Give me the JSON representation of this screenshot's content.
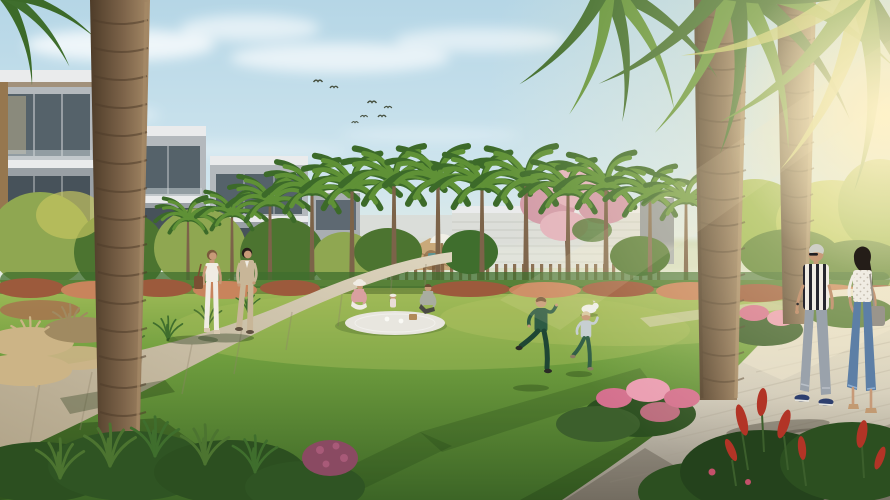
{
  "scene": {
    "description": "Golden-hour architectural rendering of a landscaped community park surrounded by modern villas and date palms",
    "sky": {
      "clouds": true,
      "birds_count": 7,
      "sun_position": "upper-right glare"
    },
    "architecture": [
      "row of modern flat-roof villas with glass balconies on the left",
      "low white slatted community wall and grey buildings behind the central trees"
    ],
    "landscape": [
      "curved beige pedestrian path sweeping from bottom-left to center",
      "wide paved promenade across the bottom-right",
      "large central lawn with long tree shadows",
      "row of date palms along the lawn edge",
      "pink flowering tree at center-right",
      "reddish shrub hedge bordering the lawn",
      "pink and red flowering shrubs beside the promenade",
      "tan ornamental grasses at lower-left",
      "children's playground with wooden lattice huts, white parasol and small teal slide",
      "two large foreground palm trunks with backlit fronds overhead"
    ],
    "people": [
      {
        "id": "path-couple",
        "desc": "woman in white with brown shoulder bag and man in beige suit walking on the curved path"
      },
      {
        "id": "picnic-family",
        "desc": "mother in sun hat, toddler and father seated on a light blanket on the lawn"
      },
      {
        "id": "running-children",
        "desc": "boy in dark green and smaller child in light top running on the grass"
      },
      {
        "id": "promenade-couple",
        "desc": "man in black-and-white striped shirt and woman with long dark hair, white dotted blouse and blue jeans walking on the promenade"
      }
    ],
    "animals": [
      {
        "id": "small-white-dog",
        "desc": "small white dog resting on the lawn near the family"
      }
    ]
  },
  "colors": {
    "sky_top": "#b5d6e6",
    "sky_mid": "#cfe5ee",
    "sky_horizon": "#ecefe0",
    "sun_glow": "#fff2c8",
    "cloud": "#ffffff",
    "lawn_far": "#a3bc59",
    "lawn_mid": "#6f9e3e",
    "lawn_near": "#3c6526",
    "shadow_green": "#16300d",
    "shadow_warm": "#3a352b",
    "path_light": "#ded5bf",
    "path_dark": "#b1a489",
    "walk_light": "#e9e2cd",
    "walk_mid": "#cfc9bb",
    "walk_dark": "#8c8578",
    "trunk_light": "#a68a67",
    "trunk_mid": "#7c6349",
    "trunk_dark": "#4e3c29",
    "palm_dark": "#3c6a29",
    "palm_mid": "#5f9136",
    "palm_light": "#8db04a",
    "frond_sun": "#bcc465",
    "wall": "#b4b9bd",
    "wall_dark": "#9aa0a5",
    "fascia": "#eaebec",
    "glass": "#55626a",
    "glass_low": "#47525a",
    "glass_warm": "#cdbd93",
    "wood": "#96774f",
    "white_bldg": "#d9dbd6",
    "hedge_green": "#3f6e2d",
    "bush_dark": "#2c4f20",
    "bush_mid": "#4c7430",
    "bush_light": "#8fa751",
    "tree_sun": "#9ab84f",
    "shrub_red": "#9c5a3c",
    "shrub_red_light": "#c8845c",
    "pink_tree": "#d29aa8",
    "pink_tree_light": "#e3b3bd",
    "flower_pink": "#d4708e",
    "flower_pink_light": "#ea9cb2",
    "flower_red": "#b23426",
    "purple_flower": "#a85a78",
    "grass_tan": "#ccb486",
    "grass_tan_dark": "#a08a61",
    "fence_wood": "#7a5a3a",
    "hut_tan": "#c9a97a",
    "hut_dark": "#8a6a47",
    "umbrella": "#f1efe6",
    "slide_teal": "#5f9391",
    "skin": "#c79a78",
    "hair_brown": "#7a5a3c",
    "hair_dark": "#241d18",
    "hair_grey": "#cfcfc8",
    "hair_blond": "#d9c9a2",
    "cloth_white": "#f0ece3",
    "suit_beige": "#c8b698",
    "bag_brown": "#7a4f33",
    "top_pink": "#d9a0a0",
    "tee_sage": "#a9ada0",
    "shorts_dark": "#4a4a42",
    "blanket": "#e8e6df",
    "basket": "#b08a5a",
    "kid_green": "#2e5c44",
    "kid_green_dark": "#1f4634",
    "kid_top": "#c4cdd3",
    "jeans_grey": "#9aa2ab",
    "jeans_blue": "#5d7fa6",
    "stripe_dark": "#26262e",
    "shoe_navy": "#2e3f6e",
    "heel_tan": "#c29a72",
    "bag_grey": "#9a958c",
    "dog_white": "#eef0ec"
  }
}
